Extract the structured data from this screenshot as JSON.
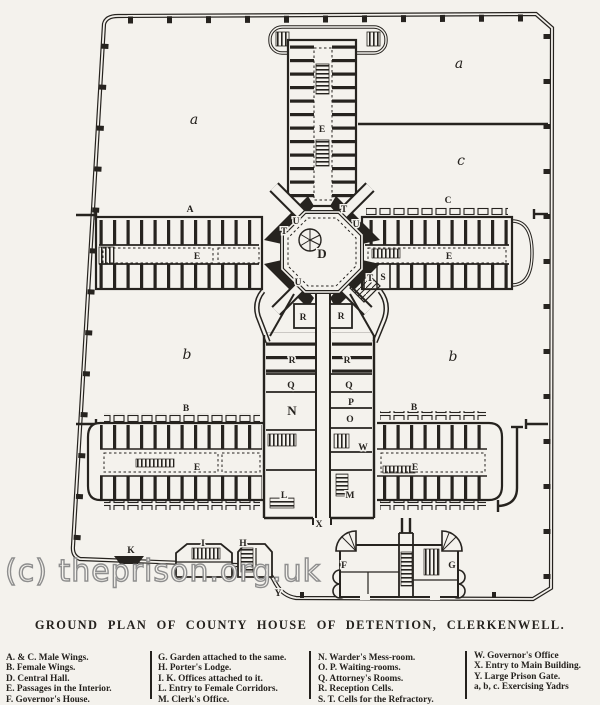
{
  "colors": {
    "ink": "#26231f",
    "paper": "#f4f2ed",
    "watermark": "#8e8e8e"
  },
  "watermark": "(c) theprison.org.uk",
  "title": "GROUND PLAN OF COUNTY HOUSE OF DETENTION, CLERKENWELL.",
  "legend": {
    "columns": [
      {
        "items": [
          "A. & C. Male Wings.",
          "B. Female Wings.",
          "D. Central Hall.",
          "E. Passages in the Interior.",
          "F. Governor's House."
        ]
      },
      {
        "items": [
          "G. Garden attached to the same.",
          "H. Porter's Lodge.",
          "I. K. Offices attached to it.",
          "L. Entry to Female Corridors.",
          "M. Clerk's Office."
        ]
      },
      {
        "items": [
          "N. Warder's Mess-room.",
          "O. P. Waiting-rooms.",
          "Q. Attorney's Rooms.",
          "R. Reception Cells.",
          "S. T. Cells for the Refractory."
        ]
      },
      {
        "items": [
          "W. Governor's Office",
          "X. Entry to Main Building.",
          "Y. Large Prison Gate.",
          "a, b, c. Exercising Yadrs"
        ]
      }
    ]
  },
  "plan": {
    "labels": [
      {
        "t": "a",
        "x": 194,
        "y": 124,
        "kind": "yard"
      },
      {
        "t": "a",
        "x": 459,
        "y": 68,
        "kind": "yard"
      },
      {
        "t": "c",
        "x": 461,
        "y": 165,
        "kind": "yard"
      },
      {
        "t": "b",
        "x": 187,
        "y": 359,
        "kind": "yard"
      },
      {
        "t": "b",
        "x": 453,
        "y": 361,
        "kind": "yard"
      },
      {
        "t": "A",
        "x": 190,
        "y": 212,
        "kind": "room"
      },
      {
        "t": "C",
        "x": 448,
        "y": 203,
        "kind": "room"
      },
      {
        "t": "B",
        "x": 186,
        "y": 411,
        "kind": "room"
      },
      {
        "t": "B",
        "x": 414,
        "y": 410,
        "kind": "room"
      },
      {
        "t": "E",
        "x": 322,
        "y": 132,
        "kind": "room"
      },
      {
        "t": "E",
        "x": 197,
        "y": 259,
        "kind": "room"
      },
      {
        "t": "E",
        "x": 449,
        "y": 259,
        "kind": "room"
      },
      {
        "t": "E",
        "x": 197,
        "y": 470,
        "kind": "room"
      },
      {
        "t": "E",
        "x": 415,
        "y": 470,
        "kind": "room"
      },
      {
        "t": "D",
        "x": 322,
        "y": 258,
        "kind": "big"
      },
      {
        "t": "T",
        "x": 284,
        "y": 234,
        "kind": "room"
      },
      {
        "t": "U",
        "x": 296,
        "y": 224,
        "kind": "room"
      },
      {
        "t": "T",
        "x": 344,
        "y": 212,
        "kind": "room"
      },
      {
        "t": "U",
        "x": 356,
        "y": 227,
        "kind": "room"
      },
      {
        "t": "U",
        "x": 298,
        "y": 285,
        "kind": "room"
      },
      {
        "t": "T",
        "x": 370,
        "y": 281,
        "kind": "room"
      },
      {
        "t": "S",
        "x": 383,
        "y": 280,
        "kind": "room"
      },
      {
        "t": "R",
        "x": 303,
        "y": 320,
        "kind": "room"
      },
      {
        "t": "R",
        "x": 341,
        "y": 319,
        "kind": "room"
      },
      {
        "t": "R",
        "x": 292,
        "y": 363,
        "kind": "room"
      },
      {
        "t": "R",
        "x": 347,
        "y": 363,
        "kind": "room"
      },
      {
        "t": "Q",
        "x": 291,
        "y": 388,
        "kind": "room"
      },
      {
        "t": "Q",
        "x": 349,
        "y": 388,
        "kind": "room"
      },
      {
        "t": "P",
        "x": 351,
        "y": 405,
        "kind": "room"
      },
      {
        "t": "N",
        "x": 292,
        "y": 415,
        "kind": "big"
      },
      {
        "t": "O",
        "x": 350,
        "y": 422,
        "kind": "room"
      },
      {
        "t": "W",
        "x": 363,
        "y": 450,
        "kind": "room"
      },
      {
        "t": "L",
        "x": 284,
        "y": 498,
        "kind": "room"
      },
      {
        "t": "M",
        "x": 350,
        "y": 498,
        "kind": "room"
      },
      {
        "t": "X",
        "x": 319,
        "y": 527,
        "kind": "room"
      },
      {
        "t": "K",
        "x": 131,
        "y": 553,
        "kind": "room"
      },
      {
        "t": "I",
        "x": 203,
        "y": 546,
        "kind": "room"
      },
      {
        "t": "H",
        "x": 243,
        "y": 546,
        "kind": "room"
      },
      {
        "t": "Y",
        "x": 278,
        "y": 596,
        "kind": "room"
      },
      {
        "t": "F",
        "x": 344,
        "y": 568,
        "kind": "room"
      },
      {
        "t": "G",
        "x": 452,
        "y": 568,
        "kind": "room"
      }
    ]
  }
}
